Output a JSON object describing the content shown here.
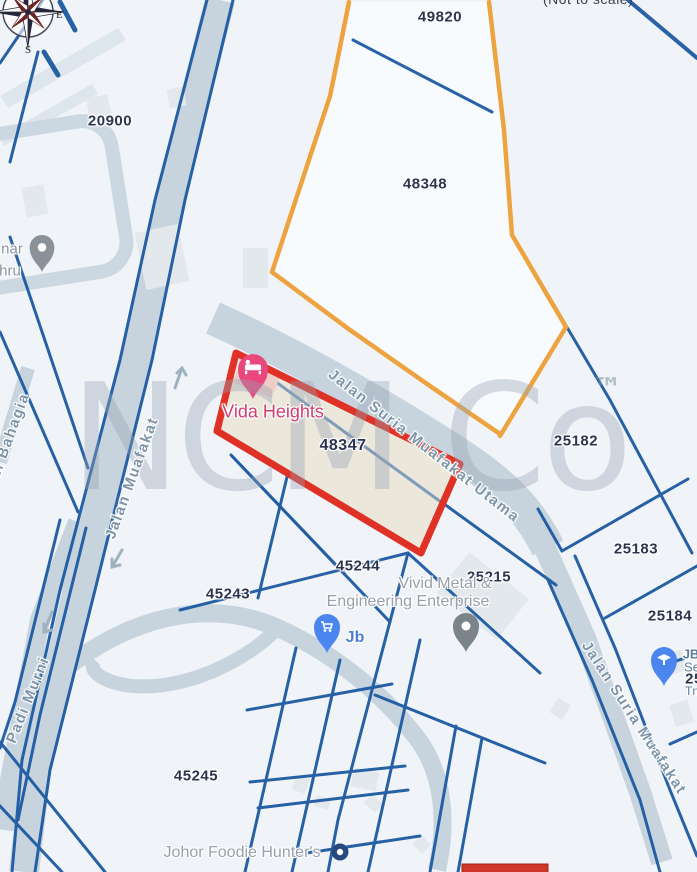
{
  "page": {
    "not_to_scale_note": "(Not to scale)"
  },
  "watermark": {
    "text": "NCM Co",
    "tm": "™"
  },
  "compass": {
    "east": "E",
    "south": "S"
  },
  "colors": {
    "highlight_outline_red": "#e03127",
    "highlight_fill_beige": "#ebe5d6",
    "survey_boundary_orange": "#eda33f",
    "parcel_line_blue": "#1d5aa1",
    "road_fill": "#c7d4de",
    "legend_swatch_red": "#cf3528"
  },
  "map": {
    "highlighted_lot": "48347",
    "lot_labels": [
      {
        "text": "49820",
        "x": 440,
        "y": 17
      },
      {
        "text": "20900",
        "x": 110,
        "y": 121
      },
      {
        "text": "48348",
        "x": 425,
        "y": 184
      },
      {
        "text": "48347",
        "x": 343,
        "y": 446,
        "big": true
      },
      {
        "text": "25182",
        "x": 576,
        "y": 441
      },
      {
        "text": "25183",
        "x": 636,
        "y": 549
      },
      {
        "text": "25184",
        "x": 670,
        "y": 616
      },
      {
        "text": "45244",
        "x": 358,
        "y": 566
      },
      {
        "text": "45243",
        "x": 228,
        "y": 594
      },
      {
        "text": "25215",
        "x": 489,
        "y": 577
      },
      {
        "text": "45245",
        "x": 196,
        "y": 776
      },
      {
        "text": "25",
        "x": 694,
        "y": 679
      }
    ],
    "road_labels": [
      {
        "text": "Jalan Muafakat",
        "x": 132,
        "y": 478,
        "angle": -70
      },
      {
        "text": "Padi Murni",
        "x": 28,
        "y": 700,
        "angle": -68
      },
      {
        "text": "Padi Bahagia",
        "x": 6,
        "y": 446,
        "angle": -70
      },
      {
        "text": "Jalan Suria Muafakat Utama",
        "x": 424,
        "y": 446,
        "angle": 38
      },
      {
        "text": "Jalan Suria Muafakat",
        "x": 634,
        "y": 718,
        "angle": 57
      }
    ],
    "poi_labels": [
      {
        "text": "Vida Heights",
        "x": 273,
        "y": 412,
        "color": "#cf3e72",
        "size": 18
      },
      {
        "text": "Vivid Metal &",
        "x": 445,
        "y": 584,
        "color": "#97a0a8",
        "size": 16
      },
      {
        "text": "Engineering Enterprise",
        "x": 408,
        "y": 602,
        "color": "#97a0a8",
        "size": 16
      },
      {
        "text": "Johor Foodie Hunter's",
        "x": 242,
        "y": 853,
        "color": "#97a0a8",
        "size": 16
      },
      {
        "text": "Jb",
        "x": 355,
        "y": 638,
        "color": "#4a7fd4",
        "size": 16,
        "bold": true
      },
      {
        "text": "nar",
        "x": 12,
        "y": 249,
        "color": "#8a949c",
        "size": 15
      },
      {
        "text": "hru",
        "x": 10,
        "y": 271,
        "color": "#8a949c",
        "size": 15
      },
      {
        "text": "JB",
        "x": 691,
        "y": 654,
        "color": "#5b7d9b",
        "size": 13,
        "bold": true
      },
      {
        "text": "Se",
        "x": 692,
        "y": 667,
        "color": "#5b7d9b",
        "size": 13
      },
      {
        "text": "Tn",
        "x": 692,
        "y": 691,
        "color": "#5b7d9b",
        "size": 12
      }
    ]
  }
}
